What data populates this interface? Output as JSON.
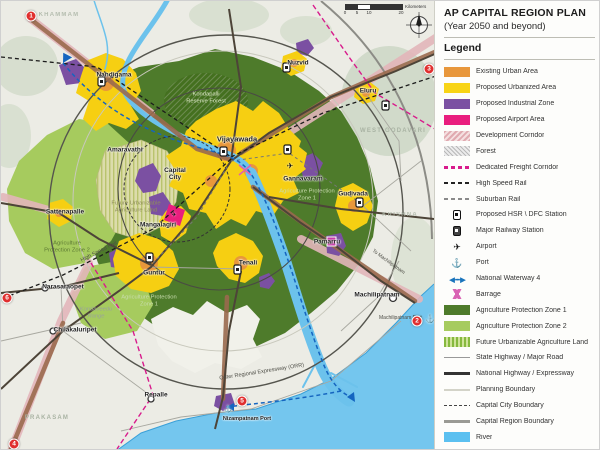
{
  "panel": {
    "title": "AP CAPITAL REGION PLAN",
    "subtitle": "(Year 2050 and beyond)",
    "legend_heading": "Legend"
  },
  "legend": {
    "items": [
      {
        "label": "Existing Urban Area",
        "color": "#E8973B"
      },
      {
        "label": "Proposed Urbanized Area",
        "color": "#F8D416"
      },
      {
        "label": "Proposed Industrial Zone",
        "color": "#7B50A2"
      },
      {
        "label": "Proposed Airport Area",
        "color": "#E91E7E"
      },
      {
        "label": "Development Corridor",
        "color": "#E0AAB0"
      },
      {
        "label": "Forest",
        "color": "#BDBDBD"
      },
      {
        "label": "Dedicated Freight Corridor",
        "color": "#D81B8C"
      },
      {
        "label": "High Speed Rail",
        "color": "#222222"
      },
      {
        "label": "Suburban Rail",
        "color": "#8A8A8A"
      },
      {
        "label": "Proposed HSR \\ DFC Station"
      },
      {
        "label": "Major Railway Station"
      },
      {
        "label": "Airport"
      },
      {
        "label": "Port"
      },
      {
        "label": "National Waterway 4",
        "color": "#1A74BC"
      },
      {
        "label": "Barrage",
        "color": "#D964B4"
      },
      {
        "label": "Agriculture Protection Zone 1",
        "color": "#4E7B2B"
      },
      {
        "label": "Agriculture Protection Zone 2",
        "color": "#A6CB5E"
      },
      {
        "label": "Future Urbanizable Agriculture Land",
        "color": "#CFE39A"
      },
      {
        "label": "State Highway / Major Road",
        "color": "#999999"
      },
      {
        "label": "National Highway / Expressway",
        "color": "#333333"
      },
      {
        "label": "Planning Boundary",
        "color": "#D3D3C8"
      },
      {
        "label": "Capital City Boundary",
        "color": "#444444"
      },
      {
        "label": "Capital Region Boundary",
        "color": "#9A9A94"
      },
      {
        "label": "River",
        "color": "#5BC0F0"
      }
    ]
  },
  "map": {
    "towns": [
      "Nandigama",
      "Nuzvid",
      "Eluru",
      "Vijayawada",
      "Gannavaram",
      "Capital City",
      "Amaravathi",
      "Mangalagiri",
      "Sattenapalle",
      "Guntur",
      "Tenali",
      "Gudivada",
      "Pamarru",
      "Machilipatnam",
      "Narasaraopet",
      "Chilakaluripet",
      "Repalle",
      "Nizampatnam Port"
    ],
    "areas": [
      "Kondapalli Reserve Forest",
      "Agriculture Protection Zone 1",
      "Agriculture Protection Zone 1",
      "Agriculture Protection Zone 2",
      "Future Urbanizable Agriculture Land",
      "Kondaveedu Range"
    ],
    "districts": [
      "KHAMMAM",
      "WEST GODAVARI",
      "KRISHNA",
      "PRAKASAM"
    ],
    "route_labels": [
      "Outer Regional Expressway (ORR)",
      "High Speed Rail",
      "To Machilipatnam",
      "Machilipatnam Port"
    ],
    "markers": [
      "1",
      "3",
      "2",
      "5",
      "4",
      "6"
    ],
    "scale_ticks": [
      "0",
      "5",
      "10",
      "20"
    ],
    "scale_unit": "Kilometers",
    "colors": {
      "agri_zone1": "#4E7B2B",
      "agri_zone2": "#A6CB5E",
      "proposed_urban": "#F8D416",
      "existing_urban": "#E8973B",
      "industrial": "#7B50A2",
      "airport_area": "#E91E7E",
      "river": "#5BC0F0",
      "freight": "#D81B8C",
      "sea": "#74C6EE"
    }
  }
}
